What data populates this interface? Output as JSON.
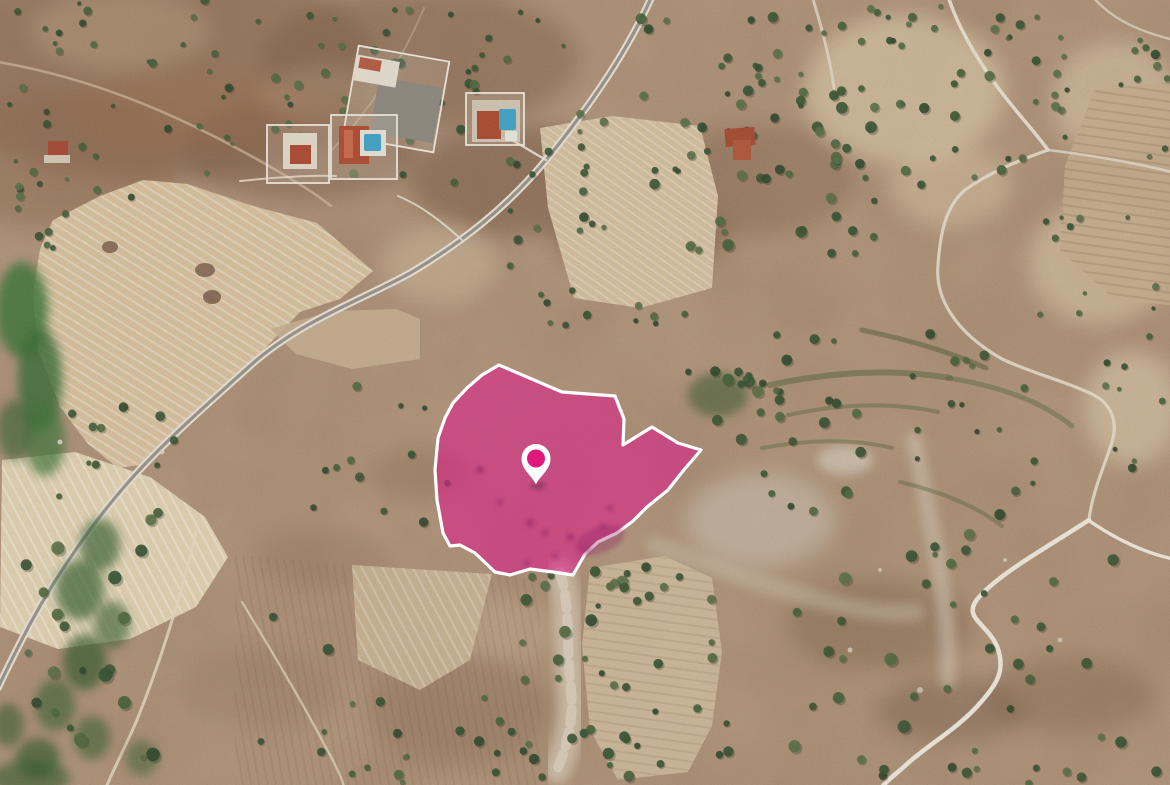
{
  "map": {
    "view_type": "satellite-imagery"
  },
  "parcel": {
    "points": "499,365 562,392 615,396 624,419 623,445 652,427 678,443 701,450 683,471 668,490 647,507 633,521 617,533 598,542 585,554 573,575 553,572 530,569 510,575 495,572 475,553 460,545 450,546 443,533 437,500 435,470 438,438 445,418 453,403 467,388 482,375",
    "fill": "#e0188a",
    "fill_opacity": "0.55",
    "stroke": "#ffffff",
    "stroke_width": "3.2"
  },
  "marker": {
    "transform": "translate(536,461)",
    "pin_fill": "#ffffff",
    "dot_fill": "#e0187c",
    "dot_radius": "9"
  },
  "palette": {
    "terrain_base": "#b29378",
    "road_casing": "#e9e3d5",
    "road_core": "#9a948a",
    "dirt_road": "#e8dfcc",
    "field_light": "#dac29e",
    "vegetation_dark": "#39542f",
    "roof_red": "#ad4a30",
    "pool_blue": "#41a5c9"
  }
}
